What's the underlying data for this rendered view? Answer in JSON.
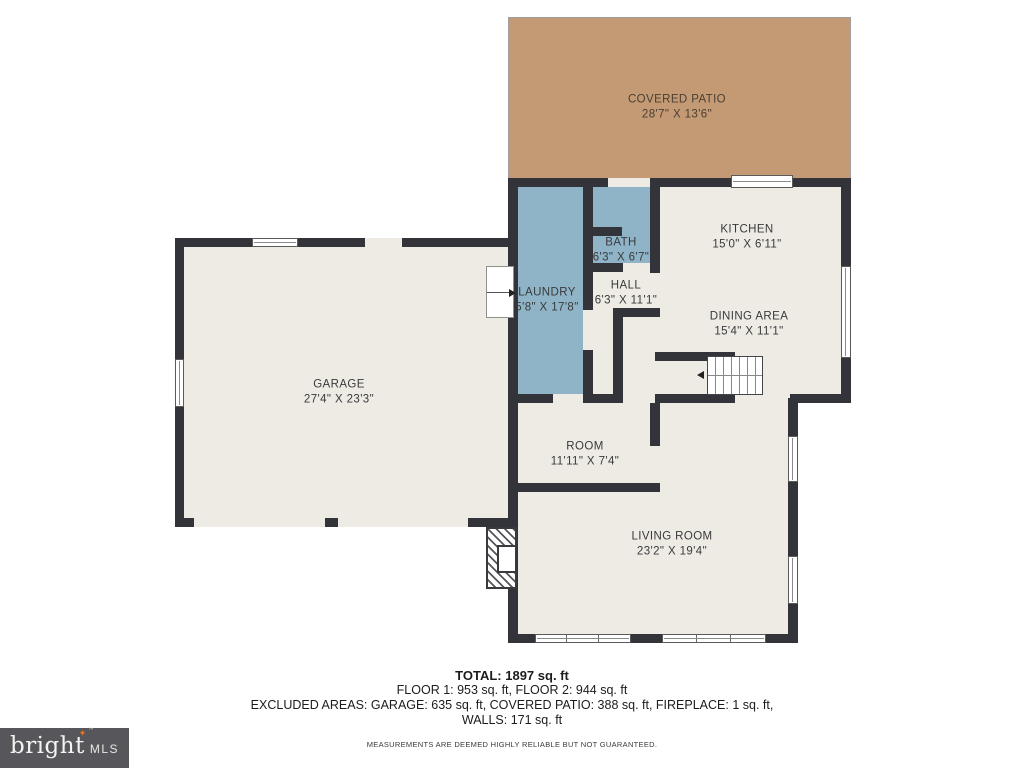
{
  "rooms": {
    "covered_patio": {
      "name": "COVERED PATIO",
      "dims": "28'7\" X 13'6\""
    },
    "kitchen": {
      "name": "KITCHEN",
      "dims": "15'0\" X 6'11\""
    },
    "bath": {
      "name": "BATH",
      "dims": "6'3\" X 6'7\""
    },
    "laundry": {
      "name": "LAUNDRY",
      "dims": "5'8\" X 17'8\""
    },
    "hall": {
      "name": "HALL",
      "dims": "6'3\" X 11'1\""
    },
    "dining_area": {
      "name": "DINING AREA",
      "dims": "15'4\" X 11'1\""
    },
    "garage": {
      "name": "GARAGE",
      "dims": "27'4\" X 23'3\""
    },
    "room": {
      "name": "ROOM",
      "dims": "11'11\" X 7'4\""
    },
    "living_room": {
      "name": "LIVING ROOM",
      "dims": "23'2\" X 19'4\""
    }
  },
  "summary": {
    "total": "TOTAL: 1897 sq. ft",
    "floors": "FLOOR 1: 953 sq. ft, FLOOR 2: 944 sq. ft",
    "excluded": "EXCLUDED AREAS: GARAGE: 635 sq. ft, COVERED PATIO: 388 sq. ft, FIREPLACE: 1 sq. ft,",
    "walls": "WALLS: 171 sq. ft",
    "disclaimer": "MEASUREMENTS ARE DEEMED HIGHLY RELIABLE BUT NOT GUARANTEED."
  },
  "logo": {
    "brand": "bright",
    "mls": "MLS",
    "tm": "™",
    "star": "✦"
  },
  "colors": {
    "wall": "#33343a",
    "floor": "#edebe4",
    "wet_rooms": "#8fb4c7",
    "patio": "#c39a74",
    "logo_bg": "#57565a",
    "logo_star": "#e87425"
  }
}
